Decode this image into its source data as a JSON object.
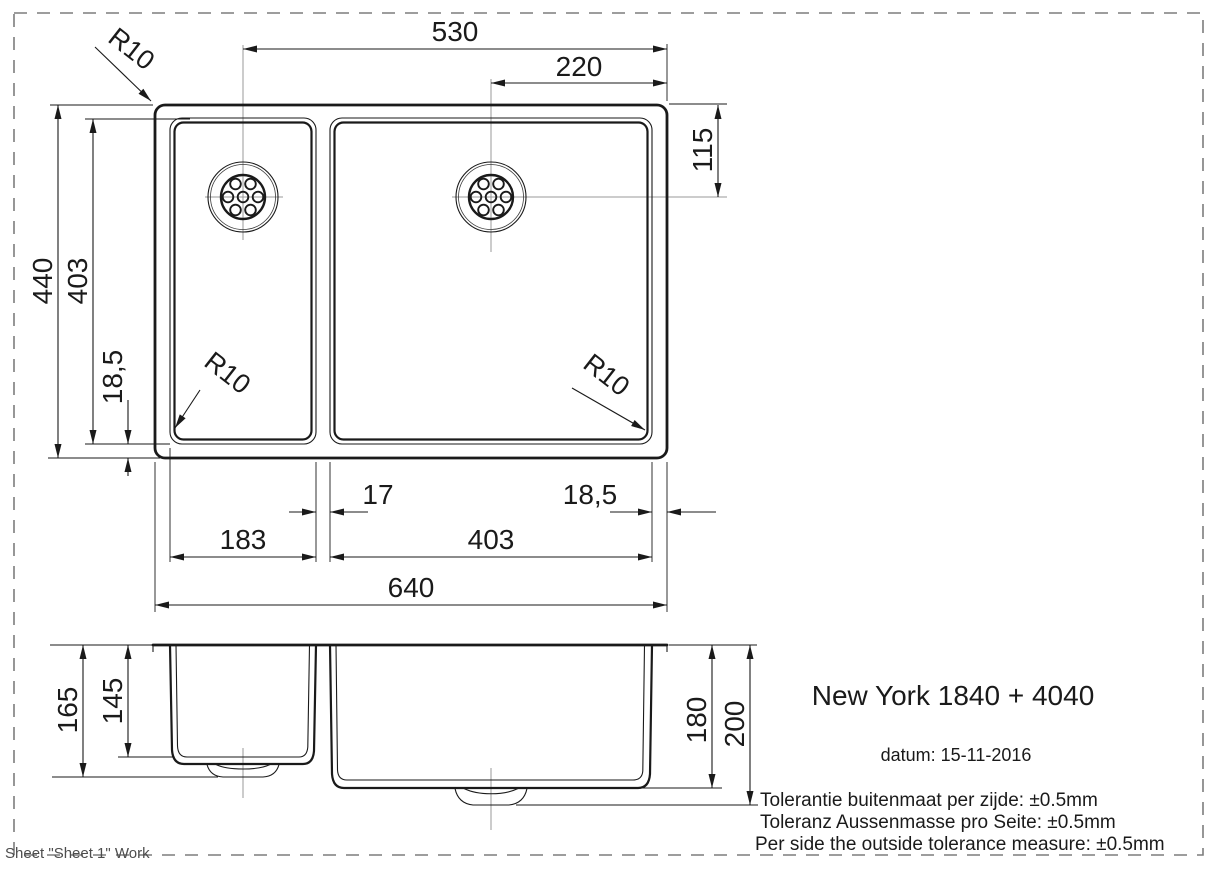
{
  "page": {
    "sheet_note": "Sheet \"Sheet 1\" Work",
    "line_color": "#1a1a1a",
    "centerline_color": "#9a9a9a",
    "border_color": "#7d7d7d"
  },
  "title_block": {
    "product": "New York 1840 + 4040",
    "date": "datum: 15-11-2016",
    "tolerance_nl": "Tolerantie buitenmaat per zijde: ±0.5mm",
    "tolerance_de": "Toleranz Aussenmasse pro Seite: ±0.5mm",
    "tolerance_en": "Per side the outside tolerance measure: ±0.5mm"
  },
  "top_view": {
    "overall_width": "640",
    "overall_depth": "440",
    "bowls_depth": "403",
    "drain_left_offset": "530",
    "drain_right_offset": "220",
    "drain_top_offset": "115",
    "edge_bottom": "18,5",
    "edge_right": "18,5",
    "divider_width": "17",
    "left_bowl_width": "183",
    "right_bowl_width": "403",
    "radius_outer": "R10",
    "radius_left_bowl": "R10",
    "radius_right_bowl": "R10"
  },
  "section_view": {
    "left_bowl_total_height": "165",
    "left_bowl_depth": "145",
    "right_bowl_depth": "180",
    "right_bowl_total_height": "200"
  }
}
